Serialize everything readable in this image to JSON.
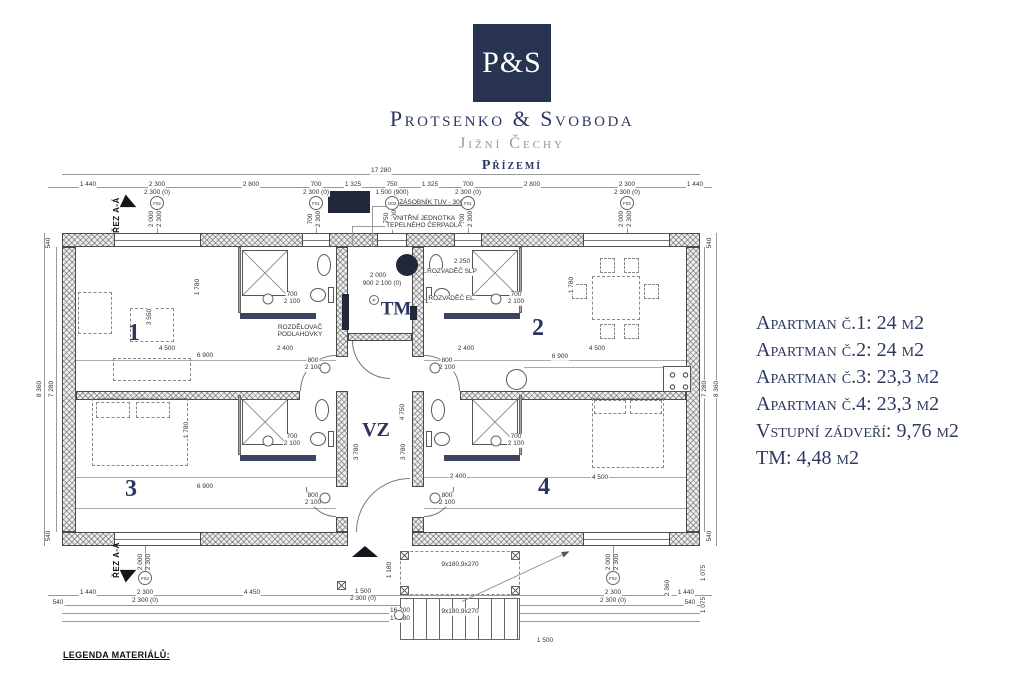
{
  "header": {
    "logo_text": "P&S",
    "company": "Protsenko & Svoboda",
    "region": "Jižní Čechy",
    "floor": "Přízemí"
  },
  "apartments": {
    "items": [
      "Apartman č.1: 24 m2",
      "Apartman č.2: 24 m2",
      "Apartman č.3: 23,3 m2",
      "Apartman č.4: 23,3 m2",
      "Vstupní zádveří: 9,76 m2",
      "TM: 4,48 m2"
    ]
  },
  "colors": {
    "navy": "#283352",
    "text_navy": "#2e3a60",
    "line": "#4a4a4a"
  },
  "plan": {
    "legend_title": "LEGENDA MATERIÁLŮ:",
    "rooms": [
      [
        "1",
        134,
        333,
        24
      ],
      [
        "2",
        538,
        328,
        24
      ],
      [
        "3",
        131,
        489,
        24
      ],
      [
        "4",
        544,
        487,
        24
      ],
      [
        "TM",
        396,
        309,
        19
      ],
      [
        "VZ",
        376,
        430,
        20
      ]
    ],
    "tags": [
      [
        "F02",
        157,
        203,
        14
      ],
      [
        "F01",
        316,
        203,
        14
      ],
      [
        "O02",
        392,
        203,
        14
      ],
      [
        "F01",
        468,
        203,
        14
      ],
      [
        "F02",
        627,
        203,
        14
      ],
      [
        "F02",
        145,
        578,
        14
      ],
      [
        "F02",
        613,
        578,
        14
      ],
      [
        "P",
        374,
        300,
        10
      ],
      [
        "",
        268,
        299,
        11
      ],
      [
        "",
        496,
        299,
        11
      ],
      [
        "",
        268,
        441,
        11
      ],
      [
        "",
        496,
        441,
        11
      ],
      [
        "",
        325,
        368,
        11
      ],
      [
        "",
        435,
        368,
        11
      ],
      [
        "",
        325,
        498,
        11
      ],
      [
        "",
        435,
        498,
        11
      ],
      [
        "",
        399,
        615,
        10
      ]
    ],
    "annotations": [
      [
        "17 280",
        381,
        171,
        ""
      ],
      [
        "1 440",
        88,
        185,
        ""
      ],
      [
        "2 300",
        157,
        185,
        ""
      ],
      [
        "2 800",
        251,
        185,
        ""
      ],
      [
        "700",
        316,
        185,
        ""
      ],
      [
        "1 325",
        353,
        185,
        ""
      ],
      [
        "750",
        392,
        185,
        ""
      ],
      [
        "1 325",
        430,
        185,
        ""
      ],
      [
        "700",
        468,
        185,
        ""
      ],
      [
        "2 800",
        532,
        185,
        ""
      ],
      [
        "2 300",
        627,
        185,
        ""
      ],
      [
        "1 440",
        695,
        185,
        ""
      ],
      [
        "2 300 (0)",
        157,
        193,
        ""
      ],
      [
        "2 300 (0)",
        316,
        193,
        ""
      ],
      [
        "1 500 (900)",
        392,
        193,
        ""
      ],
      [
        "2 300 (0)",
        468,
        193,
        ""
      ],
      [
        "2 300 (0)",
        627,
        193,
        ""
      ],
      [
        "2 000",
        152,
        219,
        "r"
      ],
      [
        "2 300",
        160,
        219,
        "r"
      ],
      [
        "700",
        311,
        219,
        "r"
      ],
      [
        "2 300",
        319,
        219,
        "r"
      ],
      [
        "750",
        387,
        218,
        "r"
      ],
      [
        "1 000",
        395,
        218,
        "r"
      ],
      [
        "700",
        463,
        219,
        "r"
      ],
      [
        "2 300",
        471,
        219,
        "r"
      ],
      [
        "2 000",
        622,
        219,
        "r"
      ],
      [
        "2 300",
        630,
        219,
        "r"
      ],
      [
        "540",
        49,
        243,
        "r"
      ],
      [
        "8 360",
        40,
        389,
        "r"
      ],
      [
        "7 280",
        52,
        389,
        "r"
      ],
      [
        "540",
        49,
        536,
        "r"
      ],
      [
        "540",
        710,
        243,
        "r"
      ],
      [
        "7 280",
        705,
        389,
        "r"
      ],
      [
        "8 360",
        717,
        389,
        "r"
      ],
      [
        "540",
        710,
        536,
        "r"
      ],
      [
        "ZÁSOBNÍK TUV - 300l",
        432,
        203,
        "u"
      ],
      [
        "VNITŘNÍ JEDNOTKA",
        424,
        219,
        ""
      ],
      [
        "TEPELNÉHO ČERPADLA",
        424,
        226,
        ""
      ],
      [
        "ROZVADĚČ SLP",
        452,
        272,
        ""
      ],
      [
        "ROZVADĚČ EL.",
        452,
        299,
        ""
      ],
      [
        "ROZDĚLOVAČ",
        300,
        328,
        ""
      ],
      [
        "PODLAHOVKY",
        300,
        335,
        ""
      ],
      [
        "2 000",
        378,
        276,
        ""
      ],
      [
        "900  2 100 (0)",
        382,
        284,
        ""
      ],
      [
        "2 250",
        462,
        262,
        ""
      ],
      [
        "700",
        292,
        295,
        ""
      ],
      [
        "2 100",
        292,
        302,
        ""
      ],
      [
        "700",
        516,
        295,
        ""
      ],
      [
        "2 100",
        516,
        302,
        ""
      ],
      [
        "700",
        292,
        437,
        ""
      ],
      [
        "2 100",
        292,
        444,
        ""
      ],
      [
        "700",
        516,
        437,
        ""
      ],
      [
        "2 100",
        516,
        444,
        ""
      ],
      [
        "800",
        313,
        361,
        ""
      ],
      [
        "2 100",
        313,
        368,
        ""
      ],
      [
        "800",
        447,
        361,
        ""
      ],
      [
        "2 100",
        447,
        368,
        ""
      ],
      [
        "800",
        313,
        496,
        ""
      ],
      [
        "2 100",
        313,
        503,
        ""
      ],
      [
        "800",
        447,
        496,
        ""
      ],
      [
        "2 100",
        447,
        503,
        ""
      ],
      [
        "4 500",
        167,
        349,
        ""
      ],
      [
        "6 900",
        205,
        356,
        ""
      ],
      [
        "2 400",
        285,
        349,
        ""
      ],
      [
        "2 400",
        466,
        349,
        ""
      ],
      [
        "6 900",
        560,
        357,
        ""
      ],
      [
        "4 500",
        597,
        349,
        ""
      ],
      [
        "6 900",
        205,
        487,
        ""
      ],
      [
        "2 400",
        458,
        477,
        ""
      ],
      [
        "4 500",
        600,
        478,
        ""
      ],
      [
        "1 780",
        198,
        287,
        "r"
      ],
      [
        "3 550",
        150,
        317,
        "r"
      ],
      [
        "1 780",
        572,
        285,
        "r"
      ],
      [
        "1 780",
        187,
        430,
        "r"
      ],
      [
        "4 750",
        403,
        412,
        "r"
      ],
      [
        "3 780",
        357,
        452,
        "r"
      ],
      [
        "3 780",
        404,
        452,
        "r"
      ],
      [
        "1 440",
        88,
        593,
        ""
      ],
      [
        "2 300",
        145,
        593,
        ""
      ],
      [
        "4 450",
        252,
        593,
        ""
      ],
      [
        "2 300",
        613,
        593,
        ""
      ],
      [
        "1 440",
        686,
        593,
        ""
      ],
      [
        "2 300 (0)",
        145,
        601,
        ""
      ],
      [
        "2 300 (0)",
        613,
        601,
        ""
      ],
      [
        "540",
        58,
        603,
        ""
      ],
      [
        "540",
        690,
        603,
        ""
      ],
      [
        "1 500",
        363,
        592,
        ""
      ],
      [
        "2 300 (0)",
        363,
        599,
        ""
      ],
      [
        "16 200",
        400,
        611,
        ""
      ],
      [
        "17 280",
        400,
        619,
        ""
      ],
      [
        "9x180,9x270",
        460,
        565,
        ""
      ],
      [
        "9x180,9x270",
        460,
        612,
        ""
      ],
      [
        "1 500",
        545,
        641,
        ""
      ],
      [
        "2 000",
        141,
        562,
        "r"
      ],
      [
        "2 300",
        149,
        562,
        "r"
      ],
      [
        "2 000",
        609,
        562,
        "r"
      ],
      [
        "2 300",
        617,
        562,
        "r"
      ],
      [
        "1 075",
        704,
        573,
        "r"
      ],
      [
        "1 075",
        704,
        605,
        "r"
      ],
      [
        "2 360",
        668,
        588,
        "r"
      ],
      [
        "1 180",
        390,
        570,
        "r"
      ],
      [
        "ŘEZ A-Á",
        117,
        215,
        "sec"
      ],
      [
        "ŘEZ A-Á",
        117,
        560,
        "sec"
      ]
    ]
  }
}
